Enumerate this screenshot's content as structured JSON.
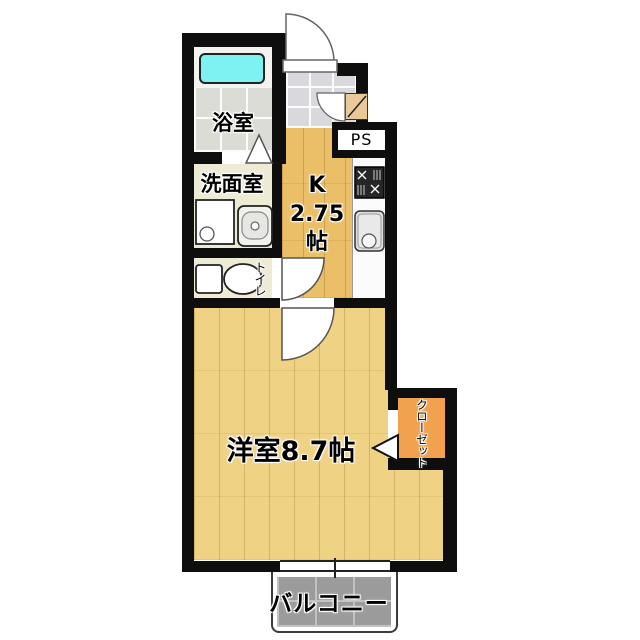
{
  "floorplan": {
    "rooms": {
      "bathroom": {
        "label": "浴室"
      },
      "washroom": {
        "label": "洗面室"
      },
      "toilet": {
        "label": "トイレ"
      },
      "kitchen": {
        "label_letter": "K",
        "label_size": "2.75",
        "label_unit": "帖"
      },
      "western_room": {
        "label": "洋室8.7帖"
      },
      "closet": {
        "label": "クローゼット"
      },
      "pipe_space": {
        "label": "PS"
      },
      "balcony": {
        "label": "バルコニー"
      }
    },
    "colors": {
      "wall": "#0e0e0e",
      "kitchen-wood": "#eabf68",
      "room-wood": "#f0d284",
      "bath-tile": "#dcdcd6",
      "genkan-tile": "#d9d9dd",
      "cream": "#eeebd5",
      "tub": "#7df2f2",
      "closet-orange": "#f2a14e",
      "balcony-tile": "#9b9b9b",
      "balcony-grout": "#c2c2c2"
    }
  }
}
